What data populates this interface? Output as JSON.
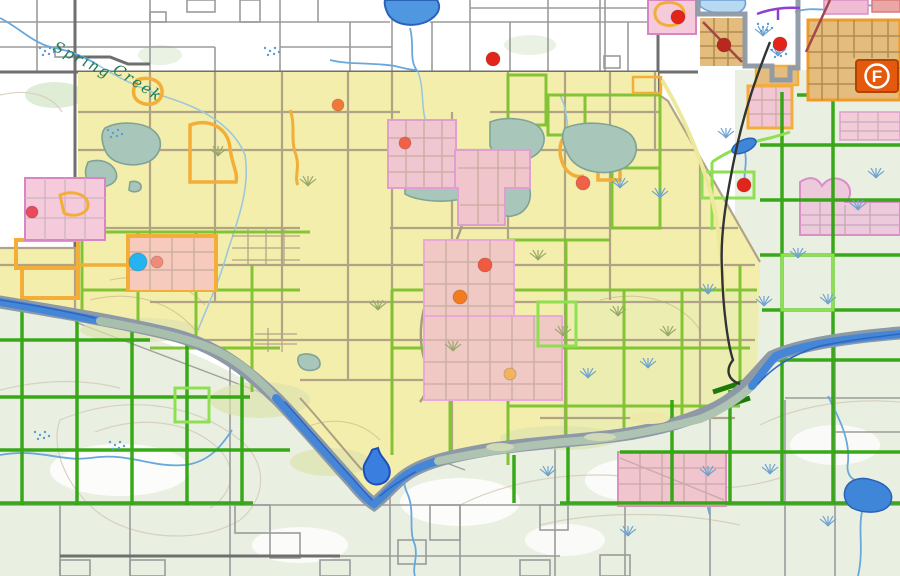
{
  "map": {
    "type": "gis-parcel-zoning-map",
    "labels": {
      "creek_part1": "Spring",
      "creek_part2": "Creek",
      "poi_badge": "F"
    },
    "palette": {
      "overlay_yellow": "#f3eeab",
      "section_green": "#2fa40e",
      "parcel_light_green": "#8ee052",
      "parcel_orange": "#f2ae38",
      "zone_pink": "#f0c6d0",
      "zone_pink_border": "#e09ed2",
      "urban_tan": "#e4bd7e",
      "water_blue": "#4586d6",
      "water_muted": "#a9bfae",
      "boundary_gray": "#8d99a6",
      "railroad_black": "#333333",
      "terrain_green": "#e9f0e1",
      "marker_red": "#e3241b",
      "marker_blue": "#25b4ef"
    },
    "badge": {
      "label": "F",
      "fill": "#e4590c",
      "border": "#b04404",
      "x": 856,
      "y": 60,
      "width": 42,
      "height": 32
    },
    "markers": [
      {
        "kind": "red-poi",
        "x": 493,
        "y": 59,
        "r": 7,
        "color": "#e3241b"
      },
      {
        "kind": "red-poi",
        "x": 678,
        "y": 17,
        "r": 7,
        "color": "#e3241b"
      },
      {
        "kind": "red-poi",
        "x": 744,
        "y": 185,
        "r": 7,
        "color": "#e3241b"
      },
      {
        "kind": "red-poi",
        "x": 780,
        "y": 44,
        "r": 7,
        "color": "#e3241b"
      },
      {
        "kind": "dark-red-poi",
        "x": 724,
        "y": 45,
        "r": 7,
        "color": "#b8281e"
      },
      {
        "kind": "red-orange-poi",
        "x": 405,
        "y": 143,
        "r": 6,
        "color": "#ef6148"
      },
      {
        "kind": "red-orange-poi",
        "x": 485,
        "y": 265,
        "r": 7,
        "color": "#ef5a40"
      },
      {
        "kind": "red-orange-poi",
        "x": 583,
        "y": 183,
        "r": 7,
        "color": "#ef6148"
      },
      {
        "kind": "orange-poi",
        "x": 338,
        "y": 105,
        "r": 6,
        "color": "#f0793a"
      },
      {
        "kind": "orange-poi",
        "x": 460,
        "y": 297,
        "r": 7,
        "color": "#f27c1e"
      },
      {
        "kind": "light-orange-poi",
        "x": 510,
        "y": 374,
        "r": 6,
        "color": "#f2b45c"
      },
      {
        "kind": "blue-poi",
        "x": 138,
        "y": 262,
        "r": 9,
        "color": "#25b4ef"
      },
      {
        "kind": "salmon-poi",
        "x": 157,
        "y": 262,
        "r": 6,
        "color": "#ee8b7a"
      },
      {
        "kind": "pink-red-poi",
        "x": 32,
        "y": 212,
        "r": 6,
        "color": "#ea4a5e"
      }
    ]
  }
}
